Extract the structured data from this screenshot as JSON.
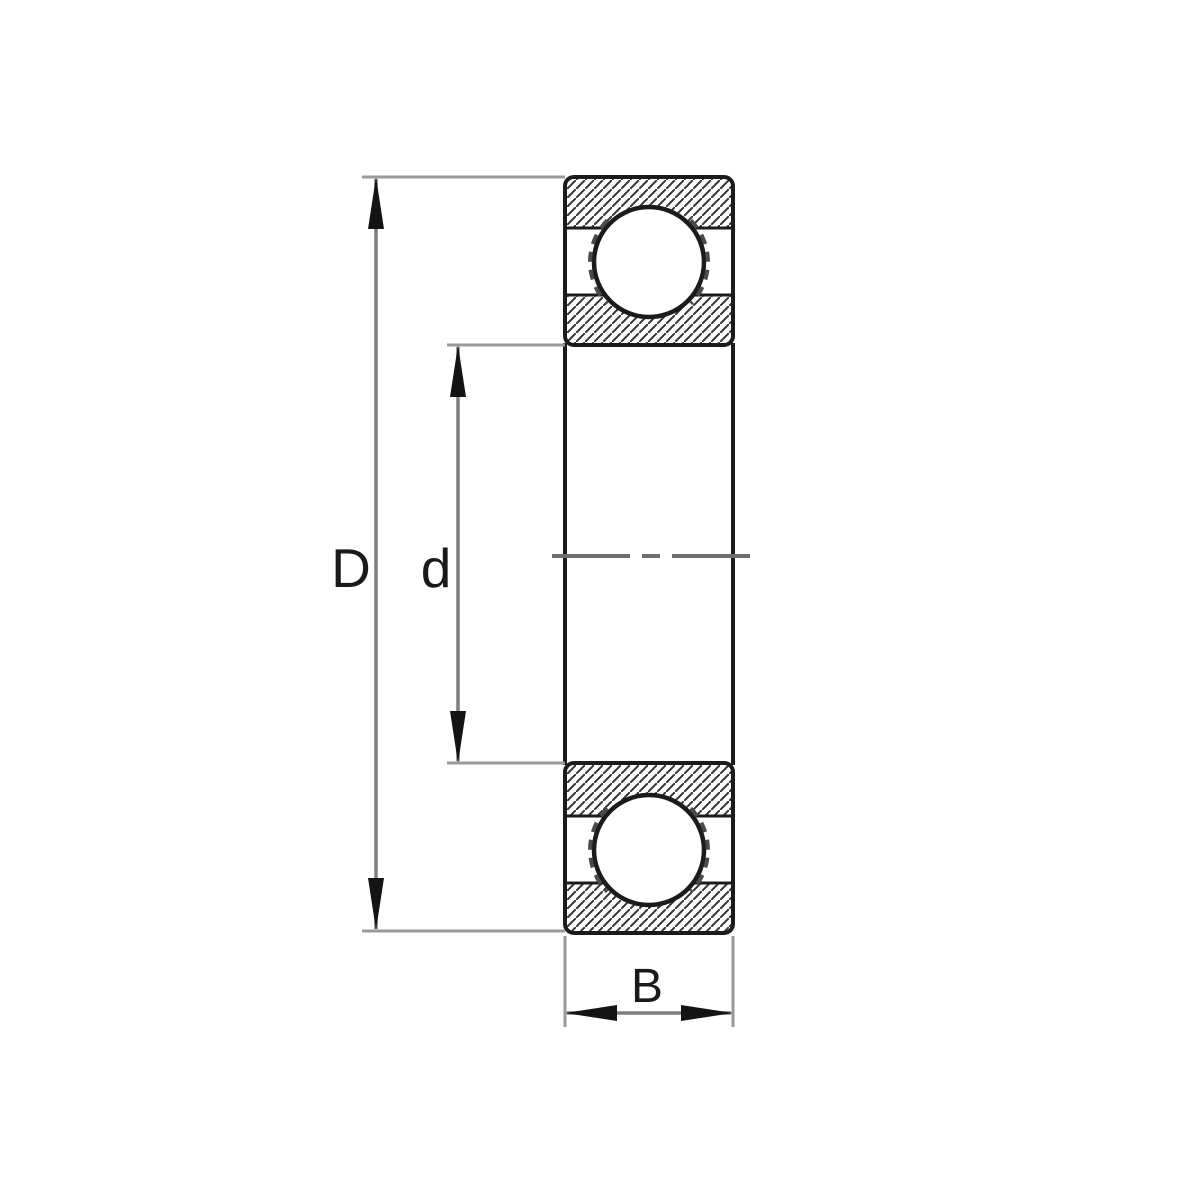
{
  "figure": {
    "kind": "technical-drawing",
    "subject": "deep-groove-ball-bearing-cross-section",
    "dimensions": {
      "outer_diameter_label": "D",
      "bore_diameter_label": "d",
      "width_label": "B"
    },
    "colors": {
      "background": "#ffffff",
      "outline": "#1b1b1b",
      "hatch": "#333333",
      "dimension_line": "#7e7e7e",
      "extension_line": "#9a9a9a",
      "arrowhead": "#141414",
      "centerline": "#6f6f6f",
      "cage_dash": "#4a4a4a"
    }
  }
}
